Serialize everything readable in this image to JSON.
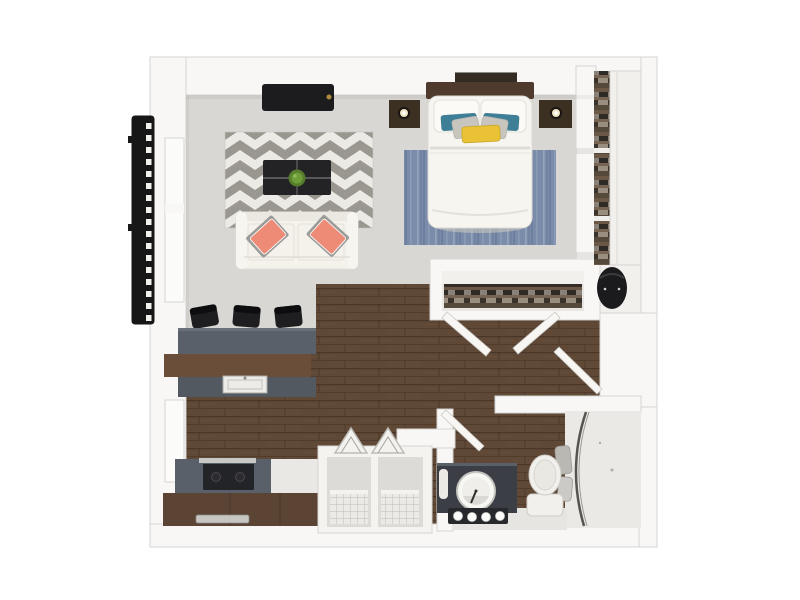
{
  "scene": {
    "type": "3d-floor-plan-top-view",
    "rooms": [
      "living-area",
      "sleeping-area",
      "kitchen",
      "hallway",
      "closet",
      "bathroom"
    ],
    "item_counts": {
      "bar_stools": 3,
      "sofa_accent_pillows": 2,
      "bed_pillows": 6,
      "vanity_bulbs": 4,
      "storage_baskets": 2,
      "nightstand_lamps": 2
    }
  },
  "colors": {
    "bg": "#ffffff",
    "wall": "#f8f7f5",
    "wall_edge": "#d6d5d2",
    "wall_recess": "#fbfbf9",
    "carpet": "#d8d7d3",
    "wood_base": "#5f4836",
    "wood_dark": "#4a3627",
    "wood_light": "#73573f",
    "rug_gray": "#9a9690",
    "rug_white": "#eceae4",
    "sofa": "#f4f2eb",
    "sofa_arm": "#f7f5ef",
    "pillow_coral": "#ee8b77",
    "table_dark": "#232326",
    "plant_green": "#6f9d3a",
    "tv_black": "#1c1c1e",
    "gold": "#b08d3e",
    "island_gray": "#5a6069",
    "island_gray_dark": "#535961",
    "counter_brown": "#6b4e3a",
    "cabinet_brown": "#5c4435",
    "stool_black": "#1e1e21",
    "stove_black": "#232428",
    "steel": "#c8c8c5",
    "sink_white": "#ecebe7",
    "bed_white": "#f6f5f0",
    "pillow_white": "#fbfaf6",
    "headboard_brown": "#4e3b2d",
    "nightstand_brown": "#3c3023",
    "art_dark": "#342b22",
    "lamp_glow": "#f0e6c6",
    "pillow_teal": "#3e7e96",
    "pillow_gray": "#c8c5bf",
    "throw_yellow": "#e9c236",
    "bedrug_base": "#7a8ca9",
    "bedrug_light": "#9aa9c2",
    "bedrug_dark": "#5e7292",
    "chair_black": "#1b1b1d",
    "vanity_dark": "#3b3e44",
    "bulb_shelf": "#26282b",
    "clock_rim": "#f7f7f4",
    "clock_face": "#efeeeb",
    "toilet_white": "#f1f0ec",
    "shower_floor": "#eae9e5",
    "bath_tile": "#e6e5e1",
    "glass_dark": "#55544f",
    "towel_gray": "#b9b8b3",
    "ladder_black": "#171717",
    "ladder_rung": "#f2f2ef",
    "basket_white": "#f4f3f0",
    "basket_inner": "#dcdbd7",
    "mesh_gray": "#bcbab5",
    "closet_floor": "#f1f0ed",
    "clothes_base": "#4a4038",
    "clothes_palette": [
      "#6b5846",
      "#8a8178",
      "#2e2a26",
      "#776452",
      "#3a332c",
      "#9a8e80",
      "#55493c"
    ],
    "door_leaf": "#f7f6f3"
  }
}
